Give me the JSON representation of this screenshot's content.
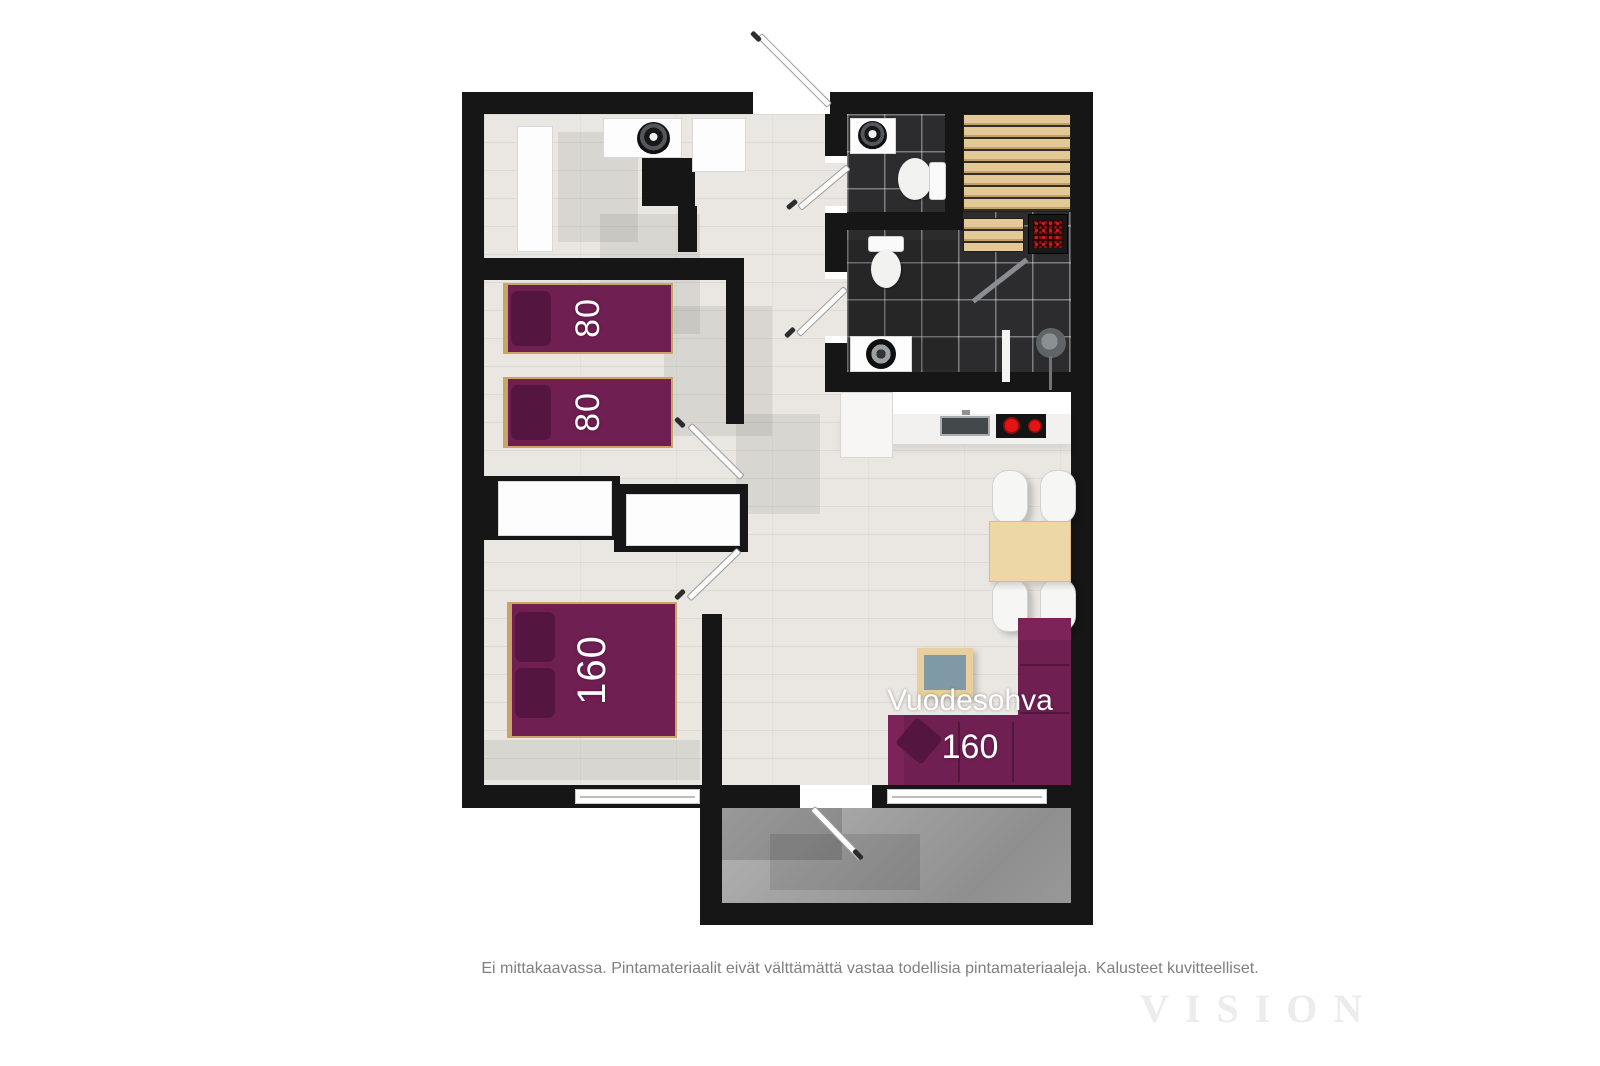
{
  "plan": {
    "colors": {
      "wall": "#161616",
      "floor": "#eae7e2",
      "tile": "#2c2c2e",
      "purple": "#701f53",
      "purple_dark": "#541641",
      "sauna_wood": "#ddc28d",
      "table_wood": "#eed7a6",
      "terrace": "#a4a4a4",
      "burner_red": "#cf1010"
    },
    "labels": {
      "bed_single_top": "80",
      "bed_single_bottom": "80",
      "bed_double": "160",
      "sofa_name": "Vuodesohva",
      "sofa_size": "160"
    },
    "footer": {
      "disclaimer": "Ei mittakaavassa. Pintamateriaalit eivät välttämättä vastaa todellisia pintamateriaaleja. Kalusteet kuvitteelliset.",
      "watermark": "VISION"
    }
  }
}
